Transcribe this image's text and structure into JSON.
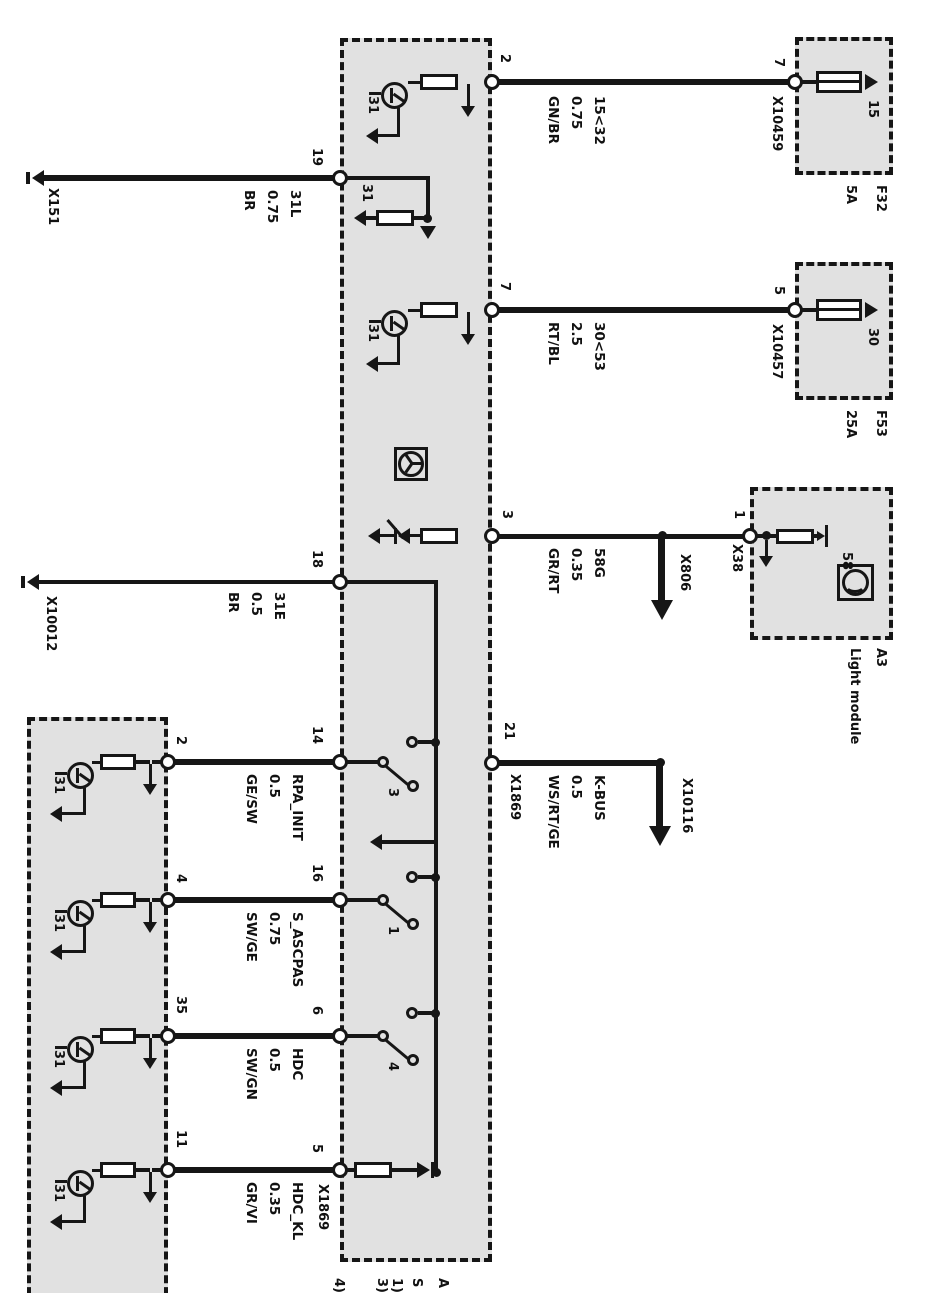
{
  "main_module": {
    "pins": {
      "p2": "2",
      "p7": "7",
      "p3": "3",
      "p21": "21",
      "p19": "19",
      "p18": "18",
      "p14": "14",
      "p16": "16",
      "p6": "6",
      "p5": "5"
    },
    "switches": {
      "s3": "3",
      "s1": "1",
      "s4": "4"
    },
    "ground_terminal": "31"
  },
  "bottom_module": {
    "pins": {
      "p2": "2",
      "p4": "4",
      "p35": "35",
      "p11": "11"
    },
    "ground_terminal": "31"
  },
  "fuses": {
    "f32": {
      "name": "F32",
      "rating": "5A",
      "pin": "7",
      "terminal": "15"
    },
    "f53": {
      "name": "F53",
      "rating": "25A",
      "pin": "5",
      "terminal": "30"
    }
  },
  "light_module": {
    "id": "A3",
    "name": "Light module",
    "pin": "1",
    "terminal": "58"
  },
  "wires": {
    "w2": {
      "label": "15<32",
      "gauge": "0.75",
      "color": "GN/BR"
    },
    "w7": {
      "label": "30<53",
      "gauge": "2.5",
      "color": "RT/BL"
    },
    "w3": {
      "label": "58G",
      "gauge": "0.35",
      "color": "GR/RT"
    },
    "w21": {
      "label": "K-BUS",
      "gauge": "0.5",
      "color": "WS/RT/GE"
    },
    "w19": {
      "label": "31L",
      "gauge": "0.75",
      "color": "BR"
    },
    "w18": {
      "label": "31E",
      "gauge": "0.5",
      "color": "BR"
    },
    "w14": {
      "label": "RPA_INIT",
      "gauge": "0.5",
      "color": "GE/SW"
    },
    "w16": {
      "label": "S_ASCPAS",
      "gauge": "0.75",
      "color": "SW/GE"
    },
    "w6": {
      "label": "HDC",
      "gauge": "0.5",
      "color": "SW/GN"
    },
    "w5": {
      "label": "HDC_KL",
      "gauge": "0.35",
      "color": "GR/VI"
    }
  },
  "connectors": {
    "x151": "X151",
    "x10012": "X10012",
    "x10459": "X10459",
    "x10457": "X10457",
    "x38": "X38",
    "x806": "X806",
    "x10116": "X10116",
    "x1869": "X1869"
  },
  "footnotes": {
    "a": "A",
    "s": "S",
    "n1": "1)",
    "n3": "3)",
    "n4": "4)"
  }
}
